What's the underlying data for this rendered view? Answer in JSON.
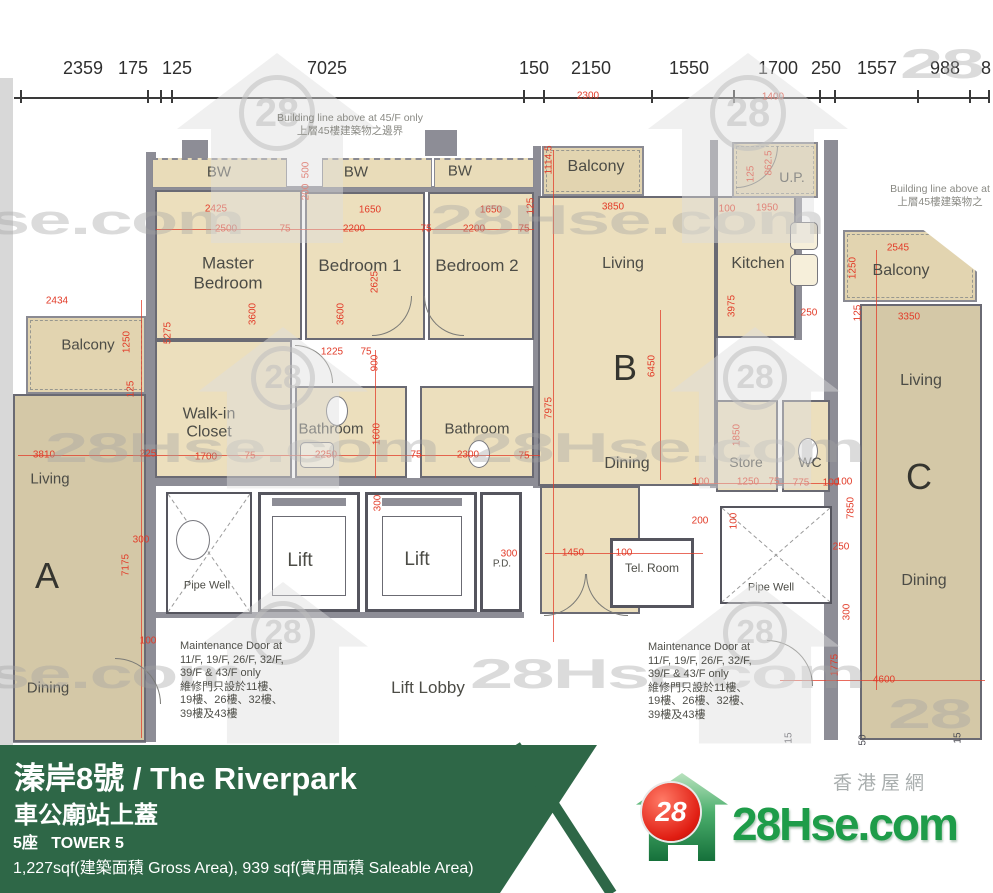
{
  "page": {
    "width": 993,
    "height": 893
  },
  "top_ruler": {
    "labels": [
      {
        "t": "2359",
        "x": 83
      },
      {
        "t": "175",
        "x": 133
      },
      {
        "t": "125",
        "x": 177
      },
      {
        "t": "7025",
        "x": 327
      },
      {
        "t": "150",
        "x": 534
      },
      {
        "t": "2150",
        "x": 591
      },
      {
        "t": "1550",
        "x": 689
      },
      {
        "t": "1700",
        "x": 778
      },
      {
        "t": "250",
        "x": 826
      },
      {
        "t": "1557",
        "x": 877
      },
      {
        "t": "988",
        "x": 945
      },
      {
        "t": "8",
        "x": 986
      }
    ]
  },
  "plan": {
    "room_labels": [
      {
        "t": "BW",
        "x": 219,
        "y": 172,
        "fs": 15
      },
      {
        "t": "BW",
        "x": 356,
        "y": 172,
        "fs": 15
      },
      {
        "t": "BW",
        "x": 460,
        "y": 171,
        "fs": 15
      },
      {
        "t": "Master\nBedroom",
        "x": 228,
        "y": 273,
        "fs": 17
      },
      {
        "t": "Bedroom 1",
        "x": 360,
        "y": 266,
        "fs": 17
      },
      {
        "t": "Bedroom 2",
        "x": 477,
        "y": 266,
        "fs": 17
      },
      {
        "t": "Balcony",
        "x": 596,
        "y": 167,
        "fs": 16
      },
      {
        "t": "Living",
        "x": 623,
        "y": 264,
        "fs": 16
      },
      {
        "t": "Kitchen",
        "x": 758,
        "y": 264,
        "fs": 16
      },
      {
        "t": "U.P.",
        "x": 792,
        "y": 177,
        "fs": 14
      },
      {
        "t": "Balcony",
        "x": 901,
        "y": 271,
        "fs": 16
      },
      {
        "t": "Living",
        "x": 921,
        "y": 381,
        "fs": 16
      },
      {
        "t": "Balcony",
        "x": 88,
        "y": 345,
        "fs": 15
      },
      {
        "t": "Walk-in\nCloset",
        "x": 209,
        "y": 424,
        "fs": 16
      },
      {
        "t": "Bathroom",
        "x": 331,
        "y": 429,
        "fs": 15
      },
      {
        "t": "Bathroom",
        "x": 477,
        "y": 429,
        "fs": 15
      },
      {
        "t": "Living",
        "x": 50,
        "y": 479,
        "fs": 15
      },
      {
        "t": "Dining",
        "x": 627,
        "y": 464,
        "fs": 16
      },
      {
        "t": "Store",
        "x": 746,
        "y": 462,
        "fs": 14
      },
      {
        "t": "WC",
        "x": 810,
        "y": 462,
        "fs": 14
      },
      {
        "t": "Dining",
        "x": 48,
        "y": 688,
        "fs": 15
      },
      {
        "t": "Dining",
        "x": 924,
        "y": 581,
        "fs": 16
      },
      {
        "t": "Lift",
        "x": 300,
        "y": 561,
        "fs": 19
      },
      {
        "t": "Lift",
        "x": 417,
        "y": 560,
        "fs": 19
      },
      {
        "t": "P.D.",
        "x": 502,
        "y": 564,
        "fs": 10
      },
      {
        "t": "Tel. Room",
        "x": 652,
        "y": 569,
        "fs": 12
      },
      {
        "t": "Pipe Well",
        "x": 207,
        "y": 586,
        "fs": 11
      },
      {
        "t": "Pipe Well",
        "x": 771,
        "y": 588,
        "fs": 11
      },
      {
        "t": "Lift Lobby",
        "x": 428,
        "y": 688,
        "fs": 17
      }
    ],
    "unit_labels": [
      {
        "t": "A",
        "x": 47,
        "y": 576
      },
      {
        "t": "B",
        "x": 625,
        "y": 368
      },
      {
        "t": "C",
        "x": 919,
        "y": 477
      }
    ],
    "dims": [
      [
        "2300",
        588,
        96
      ],
      [
        "1400",
        773,
        97
      ],
      [
        "2425",
        216,
        209
      ],
      [
        "2500",
        226,
        229
      ],
      [
        "75",
        285,
        229
      ],
      [
        "1650",
        370,
        210
      ],
      [
        "2200",
        354,
        229
      ],
      [
        "75",
        426,
        229
      ],
      [
        "1650",
        491,
        210
      ],
      [
        "2200",
        474,
        229
      ],
      [
        "75",
        524,
        229
      ],
      [
        "500",
        306,
        170,
        1
      ],
      [
        "200",
        306,
        192,
        1
      ],
      [
        "2625",
        375,
        282,
        1
      ],
      [
        "3600",
        341,
        314,
        1
      ],
      [
        "5275",
        168,
        333,
        1
      ],
      [
        "3600",
        253,
        314,
        1
      ],
      [
        "2434",
        57,
        301
      ],
      [
        "1250",
        127,
        342,
        1
      ],
      [
        "125",
        131,
        389,
        1
      ],
      [
        "3810",
        44,
        455
      ],
      [
        "225",
        148,
        454
      ],
      [
        "1700",
        206,
        457
      ],
      [
        "75",
        250,
        456
      ],
      [
        "7175",
        126,
        565,
        1
      ],
      [
        "300",
        141,
        540
      ],
      [
        "100",
        148,
        641
      ],
      [
        "1225",
        332,
        352
      ],
      [
        "75",
        366,
        352
      ],
      [
        "900",
        375,
        363,
        1
      ],
      [
        "1600",
        377,
        434,
        1
      ],
      [
        "2250",
        326,
        455
      ],
      [
        "75",
        416,
        455
      ],
      [
        "2300",
        468,
        455
      ],
      [
        "75",
        524,
        456
      ],
      [
        "1114.5",
        549,
        160,
        1
      ],
      [
        "125",
        531,
        206,
        1
      ],
      [
        "3850",
        613,
        207
      ],
      [
        "7975",
        549,
        408,
        1
      ],
      [
        "6450",
        652,
        366,
        1
      ],
      [
        "300",
        378,
        503,
        1
      ],
      [
        "100",
        727,
        209
      ],
      [
        "1950",
        767,
        208
      ],
      [
        "125",
        751,
        174,
        1
      ],
      [
        "862.5",
        769,
        163,
        1
      ],
      [
        "3975",
        732,
        306,
        1
      ],
      [
        "250",
        809,
        313
      ],
      [
        "2545",
        898,
        248
      ],
      [
        "1250",
        853,
        268,
        1
      ],
      [
        "125",
        858,
        313,
        1
      ],
      [
        "3350",
        909,
        317
      ],
      [
        "100",
        844,
        482
      ],
      [
        "7850",
        851,
        508,
        1
      ],
      [
        "250",
        841,
        547
      ],
      [
        "300",
        847,
        612,
        1
      ],
      [
        "1775",
        835,
        665,
        1
      ],
      [
        "4600",
        884,
        680
      ],
      [
        "1450",
        573,
        553
      ],
      [
        "100",
        624,
        553
      ],
      [
        "200",
        700,
        521
      ],
      [
        "100",
        734,
        521,
        1
      ],
      [
        "300",
        509,
        554
      ],
      [
        "100",
        701,
        482
      ],
      [
        "1250",
        748,
        482
      ],
      [
        "75",
        774,
        482
      ],
      [
        "775",
        801,
        483
      ],
      [
        "100",
        831,
        483
      ],
      [
        "1850",
        737,
        435,
        1
      ],
      [
        "15",
        789,
        738,
        1,
        "dark"
      ],
      [
        "50",
        863,
        740,
        1,
        "dark"
      ],
      [
        "15",
        958,
        738,
        1,
        "dark"
      ]
    ],
    "building_notes": [
      {
        "en": "Building line above at 45/F only",
        "zh": "上層45樓建築物之邊界",
        "x": 350,
        "y": 112
      },
      {
        "en": "Building line above at",
        "zh": "上層45樓建築物之",
        "x": 940,
        "y": 183
      }
    ],
    "maintenance_note_lines": [
      "Maintenance Door at",
      "11/F, 19/F, 26/F, 32/F,",
      "39/F & 43/F only",
      "維修門只設於11樓、",
      "19樓、26樓、32樓、",
      "39樓及43樓"
    ],
    "watermark": {
      "text": "28Hse.com",
      "short": "28"
    }
  },
  "footer": {
    "title": "溱岸8號 / The Riverpark",
    "subtitle": "車公廟站上蓋",
    "tower_line": "5座   TOWER 5",
    "area_line": "1,227sqf(建築面積 Gross Area), 939 sqf(實用面積 Saleable Area)",
    "logo": {
      "badge": "28",
      "site": "28Hse.com",
      "tagline": "香港屋網"
    }
  },
  "colors": {
    "bar_green": "#2e6747",
    "dim_red": "#e23b28",
    "room_beige": "#ecdfbd",
    "unit_tan": "#d4c8a7",
    "wall_gray": "#8d8d96",
    "logo_green": "#1e9c49",
    "badge_red": "#e01d12"
  }
}
